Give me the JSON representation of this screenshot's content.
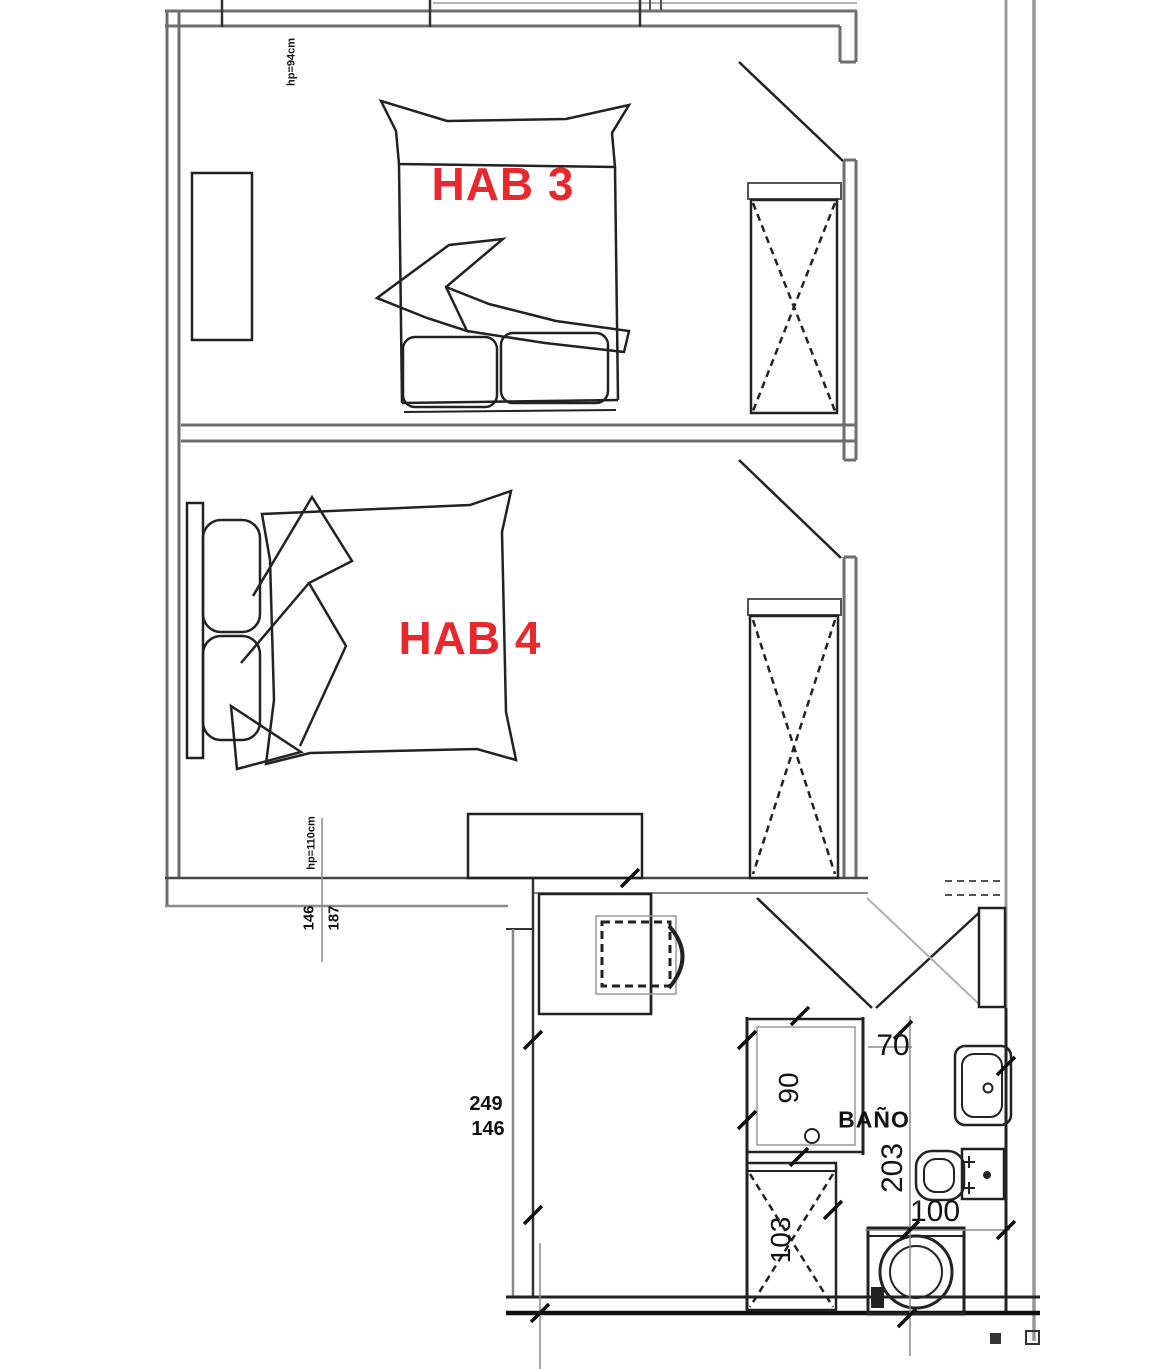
{
  "plan": {
    "rooms": [
      {
        "id": "hab3",
        "label": "HAB 3"
      },
      {
        "id": "hab4",
        "label": "HAB 4"
      },
      {
        "id": "bano",
        "label": "BAÑO"
      }
    ],
    "window_notes": [
      {
        "id": "hab3-window",
        "text": "hp=94cm"
      },
      {
        "id": "hab4-window",
        "text": "hp=110cm"
      }
    ],
    "dimensions": {
      "bath_width": "70",
      "shower_width": "90",
      "bath_length": "203",
      "washer_width": "100",
      "closet_width": "103",
      "study_a": "249",
      "study_b": "146",
      "wall_a": "146",
      "wall_b": "187"
    },
    "colors": {
      "room_label": "#e8282c",
      "wall": "#6e6e6e",
      "line": "#1f1f1f"
    }
  }
}
